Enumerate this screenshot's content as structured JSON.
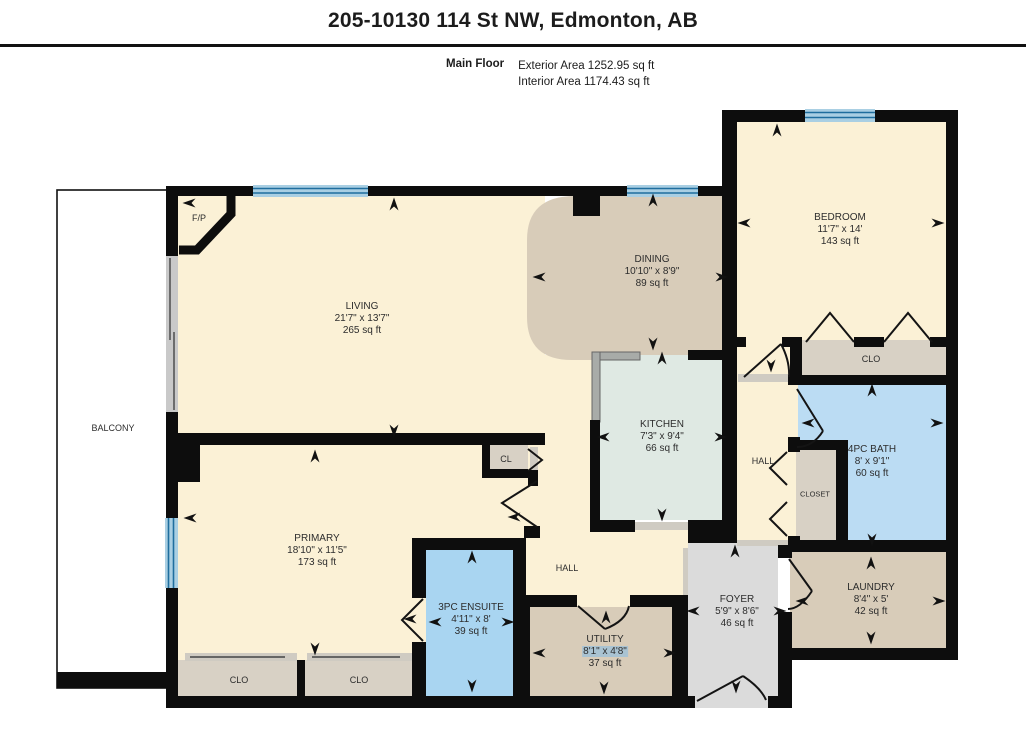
{
  "title": "205-10130 114 St NW, Edmonton, AB",
  "floor": {
    "name": "Main Floor",
    "exterior_area": "Exterior Area 1252.95 sq ft",
    "interior_area": "Interior Area 1174.43 sq ft"
  },
  "rooms": {
    "living": {
      "name": "LIVING",
      "dims": "21'7\" x 13'7\"",
      "area": "265 sq ft"
    },
    "dining": {
      "name": "DINING",
      "dims": "10'10\" x 8'9\"",
      "area": "89 sq ft"
    },
    "bedroom": {
      "name": "BEDROOM",
      "dims": "11'7\" x 14'",
      "area": "143 sq ft"
    },
    "kitchen": {
      "name": "KITCHEN",
      "dims": "7'3\" x 9'4\"",
      "area": "66 sq ft"
    },
    "primary": {
      "name": "PRIMARY",
      "dims": "18'10\" x 11'5\"",
      "area": "173 sq ft"
    },
    "ensuite": {
      "name": "3PC ENSUITE",
      "dims": "4'11\" x 8'",
      "area": "39 sq ft"
    },
    "utility": {
      "name": "UTILITY",
      "dims": "8'1\" x 4'8\"",
      "area": "37 sq ft"
    },
    "foyer": {
      "name": "FOYER",
      "dims": "5'9\" x 8'6\"",
      "area": "46 sq ft"
    },
    "laundry": {
      "name": "LAUNDRY",
      "dims": "8'4\" x 5'",
      "area": "42 sq ft"
    },
    "bath": {
      "name": "4PC BATH",
      "dims": "8' x 9'1\"",
      "area": "60 sq ft"
    }
  },
  "labels": {
    "balcony": "BALCONY",
    "fireplace": "F/P",
    "hall_upper": "HALL",
    "hall_lower": "HALL",
    "closet": "CLOSET",
    "clo_bedroom": "CLO",
    "clo_primary_1": "CLO",
    "clo_primary_2": "CLO",
    "cl": "CL"
  },
  "colors": {
    "wall": "#0d0d0d",
    "room_cream": "#FBF1D6",
    "room_tan": "#D8CCB9",
    "room_kitchen": "#DFE9E3",
    "room_bath": "#BBDCF3",
    "room_ensuite": "#A9D5F1",
    "room_closet": "#D8D1C5",
    "room_foyer": "#DBDBDB",
    "window_light": "#A9CFE3",
    "window_dark": "#1F6E9E",
    "selection_highlight": "#A9C3D2"
  }
}
